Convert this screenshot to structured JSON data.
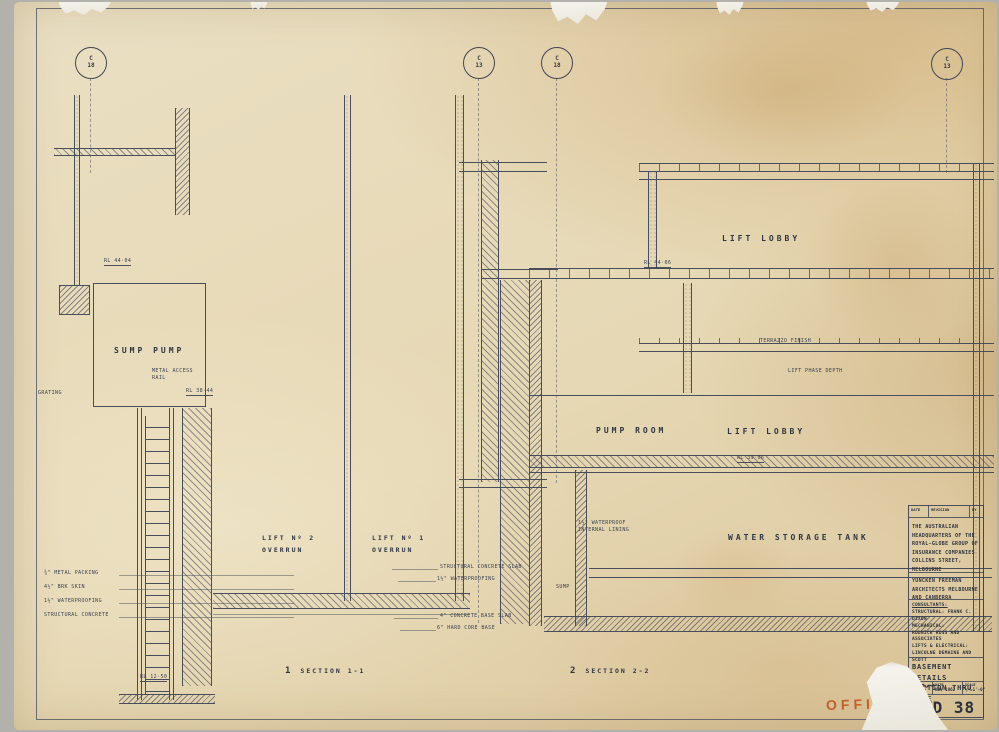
{
  "sheet": {
    "grid_markers": [
      {
        "letter": "C",
        "number": "18"
      },
      {
        "letter": "C",
        "number": "13"
      },
      {
        "letter": "C",
        "number": "18"
      },
      {
        "letter": "C",
        "number": "13"
      }
    ],
    "rooms": {
      "sump": "SUMP PUMP",
      "lobby_upper": "LIFT LOBBY",
      "pump": "PUMP ROOM",
      "lobby_mid": "LIFT LOBBY",
      "tank": "WATER STORAGE TANK",
      "lift2_l1": "LIFT Nº 2",
      "lift2_l2": "OVERRUN",
      "lift1_l1": "LIFT Nº 1",
      "lift1_l2": "OVERRUN"
    },
    "notes": {
      "rl4404": "RL 44·04",
      "metal_rail": "METAL ACCESS RAIL",
      "grating": "GRATING",
      "rl3844": "RL 38·44",
      "packing": "¾\" METAL PACKING",
      "brk": "4½\" BRK SKIN",
      "wp1": "1½\" WATERPROOFING",
      "struct": "STRUCTURAL CONCRETE",
      "rl1250": "RL 12·50",
      "slab": "STRUCTURAL CONCRETE SLAB",
      "wp2": "1½\" WATERPROOFING",
      "base": "4\" CONCRETE BASE SLAB",
      "hard": "6\" HARD CORE BASE",
      "lining": "1½\" WATERPROOF INTERNAL LINING",
      "sump_word": "SUMP",
      "terrazzo": "TERRAZZO FINISH",
      "liftphase": "LIFT PHASE DEPTH",
      "rl4406": "RL 44·06",
      "rl3906": "RL 39·06"
    },
    "sections": [
      {
        "num": "1",
        "label": "SECTION 1-1"
      },
      {
        "num": "2",
        "label": "SECTION 2-2"
      }
    ]
  },
  "title_block": {
    "header": {
      "date": "DATE",
      "revision": "REVISION",
      "by": "BY"
    },
    "project": "THE AUSTRALIAN HEADQUARTERS OF THE ROYAL-GLOBE GROUP OF INSURANCE COMPANIES COLLINS STREET, MELBOURNE",
    "architects": "YUNCKEN FREEMAN ARCHITECTS MELBOURNE AND CANBERRA",
    "consultants_label": "CONSULTANTS:",
    "structural": "STRUCTURAL: FRANK C. DIXON",
    "mechanical_label": "MECHANICAL:",
    "mechanical": "RUDNICK ROSS AND ASSOCIATES",
    "lifts_label": "LIFTS & ELECTRICAL:",
    "lifts": "LINCOLNE DEMAINE AND SCOTT",
    "title_line1": "BASEMENT DETAILS",
    "title_line2": "SECTION THRU CORE",
    "drawn_label": "DRAWN",
    "by_label": "BY",
    "date_label": "DATE",
    "date_value": "NOV 1962",
    "scale_label": "SCALE",
    "scale_value": "½\"=1'-0\"",
    "job_number": "650",
    "drawing_number": "WD 38"
  },
  "stamp": {
    "text": "OFFICE",
    "color": "#bf5a22"
  },
  "colors": {
    "ink": "#474d5a",
    "paper": "#e6d8b4",
    "stamp": "#bf5a22"
  }
}
